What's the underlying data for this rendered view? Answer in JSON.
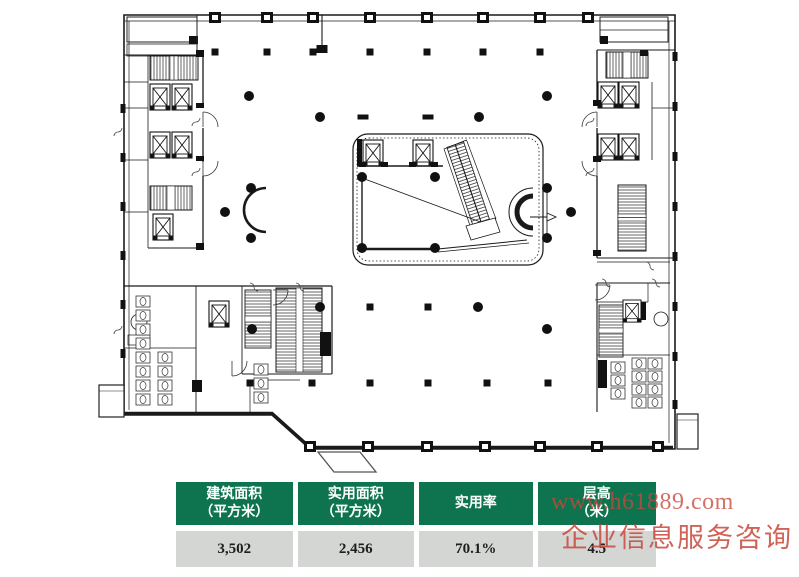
{
  "theme": {
    "header_green": "#0e7450",
    "header_text": "#ffffff",
    "row_gray": "#d3d6d2",
    "value_text": "#1e1e1e",
    "watermark_red": "#c8483c",
    "plan_line": "#1a1a1a"
  },
  "table": {
    "columns": [
      {
        "header_line1": "建筑面积",
        "header_line2": "（平方米）",
        "value": "3,502"
      },
      {
        "header_line1": "实用面积",
        "header_line2": "（平方米）",
        "value": "2,456"
      },
      {
        "header_line1": "实用率",
        "header_line2": "",
        "value": "70.1%"
      },
      {
        "header_line1": "层高",
        "header_line2": "（米）",
        "value": "4.5"
      }
    ]
  },
  "watermark": {
    "line1": "www.h61889.com",
    "line2": "企业信息服务咨询"
  }
}
